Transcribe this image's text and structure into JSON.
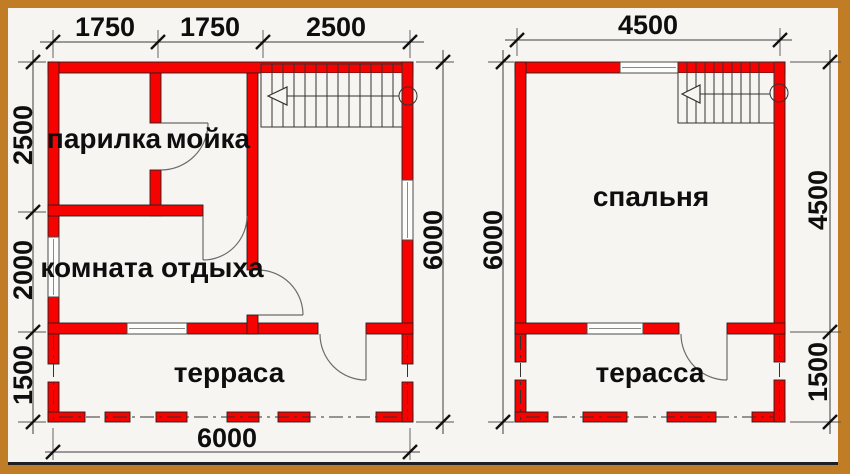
{
  "colors": {
    "wall": "#f60200",
    "frame": "#c07d26",
    "bg": "#f7f5f1",
    "ink": "#0e0e0e"
  },
  "plan_first_floor": {
    "rooms": [
      {
        "id": "parilka",
        "label": "парилка"
      },
      {
        "id": "moyka",
        "label": "мойка"
      },
      {
        "id": "komnata_otdyha",
        "label": "комната отдыха"
      },
      {
        "id": "terrasa",
        "label": "терраса"
      }
    ],
    "dimensions": {
      "top": [
        "1750",
        "1750",
        "2500"
      ],
      "left": [
        "2500",
        "2000",
        "1500"
      ],
      "right": [
        "6000"
      ],
      "bottom": [
        "6000"
      ]
    }
  },
  "plan_second_floor": {
    "rooms": [
      {
        "id": "spalnya",
        "label": "спальня"
      },
      {
        "id": "terassa",
        "label": "терасса"
      }
    ],
    "dimensions": {
      "top": [
        "4500"
      ],
      "left": [
        "6000"
      ],
      "right": [
        "4500",
        "1500"
      ]
    }
  }
}
